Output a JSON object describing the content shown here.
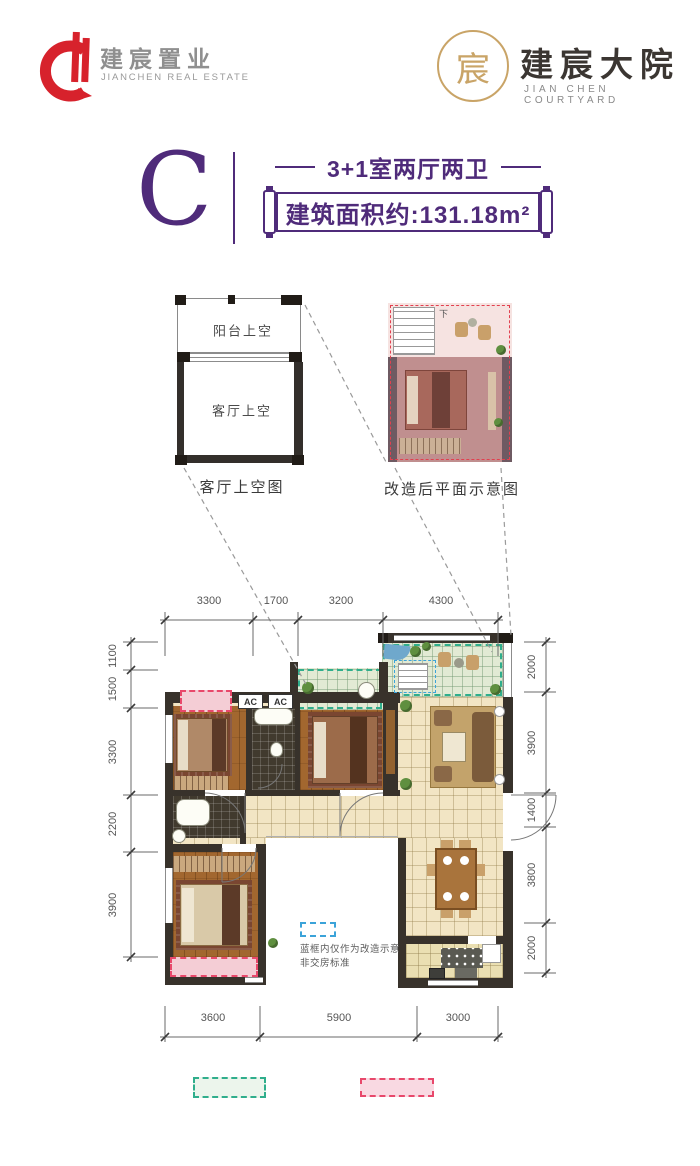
{
  "header": {
    "left_logo": {
      "name_cn": "建宸置业",
      "name_en": "JIANCHEN REAL ESTATE"
    },
    "right_logo": {
      "name_cn": "建宸大院",
      "name_en": "JIAN CHEN COURTYARD",
      "seal_char": "宸"
    }
  },
  "unit": {
    "letter": "C",
    "layout": "3+1室两厅两卫",
    "area": "建筑面积约:131.18m²"
  },
  "void_diagram": {
    "balcony": "阳台上空",
    "living": "客厅上空",
    "caption": "客厅上空图"
  },
  "reno_diagram": {
    "caption": "改造后平面示意图",
    "stair_down": "下"
  },
  "plan": {
    "ac_left": "AC",
    "ac_right": "AC",
    "note_line1": "蓝框内仅作为改造示意",
    "note_line2": "非交房标准",
    "dims": {
      "top": [
        "3300",
        "1700",
        "3200",
        "4300"
      ],
      "left": [
        "1100",
        "1500",
        "3300",
        "2200",
        "3900"
      ],
      "right": [
        "2000",
        "3900",
        "1400",
        "3800",
        "2000"
      ],
      "bottom": [
        "3600",
        "5900",
        "3000"
      ]
    }
  },
  "colors": {
    "brand_purple": "#4f2b7a",
    "logo_red": "#d7222c",
    "logo_gold": "#c9a467",
    "reno_green": "#2fae8c",
    "reno_pink": "#e8486b",
    "note_blue": "#3ba3d9"
  }
}
